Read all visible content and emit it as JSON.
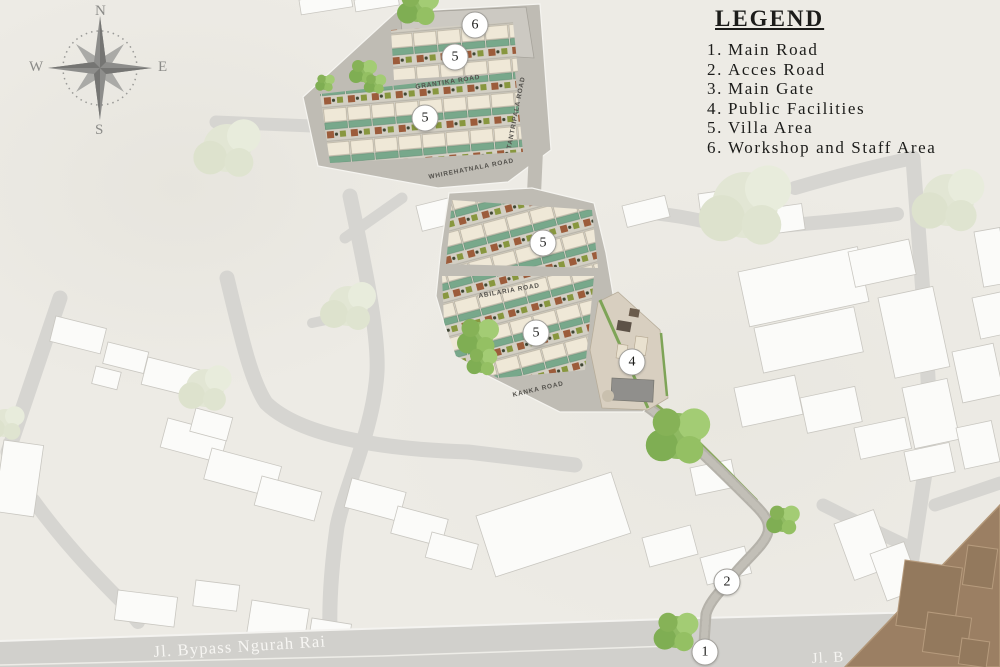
{
  "legend": {
    "title": "LEGEND",
    "items": [
      {
        "num": "1.",
        "label": "Main Road"
      },
      {
        "num": "2.",
        "label": "Acces Road"
      },
      {
        "num": "3.",
        "label": "Main Gate"
      },
      {
        "num": "4.",
        "label": "Public Facilities"
      },
      {
        "num": "5.",
        "label": "Villa Area"
      },
      {
        "num": "6.",
        "label": "Workshop and Staff Area"
      }
    ]
  },
  "compass": {
    "north": "N",
    "east": "E",
    "south": "S",
    "west": "W"
  },
  "map": {
    "road_labels": [
      {
        "text": "GRANTIKA ROAD"
      },
      {
        "text": "TANTRIPALA ROAD"
      },
      {
        "text": "WHIREHATNALA ROAD"
      },
      {
        "text": "ABILARIA ROAD"
      },
      {
        "text": "KANKA ROAD"
      }
    ],
    "main_road_label": "Jl. Bypass Ngurah Rai",
    "partial_road_label": "Jl. B",
    "markers": [
      {
        "number": "6"
      },
      {
        "number": "5"
      },
      {
        "number": "5"
      },
      {
        "number": "5"
      },
      {
        "number": "5"
      },
      {
        "number": "4"
      },
      {
        "number": "2"
      },
      {
        "number": "1"
      }
    ],
    "colors": {
      "background": "#edebe5",
      "public_road": "#d6d5d1",
      "site_pavement": "#bfbcb4",
      "villa_roof": "#efe8d7",
      "villa_pool_green": "#78a88b",
      "villa_terracotta": "#9c5c3b",
      "tree_bright": "#8fba62",
      "tree_pale": "#e2e6d4",
      "corner_overlay_brown": "#9b7f63"
    }
  }
}
